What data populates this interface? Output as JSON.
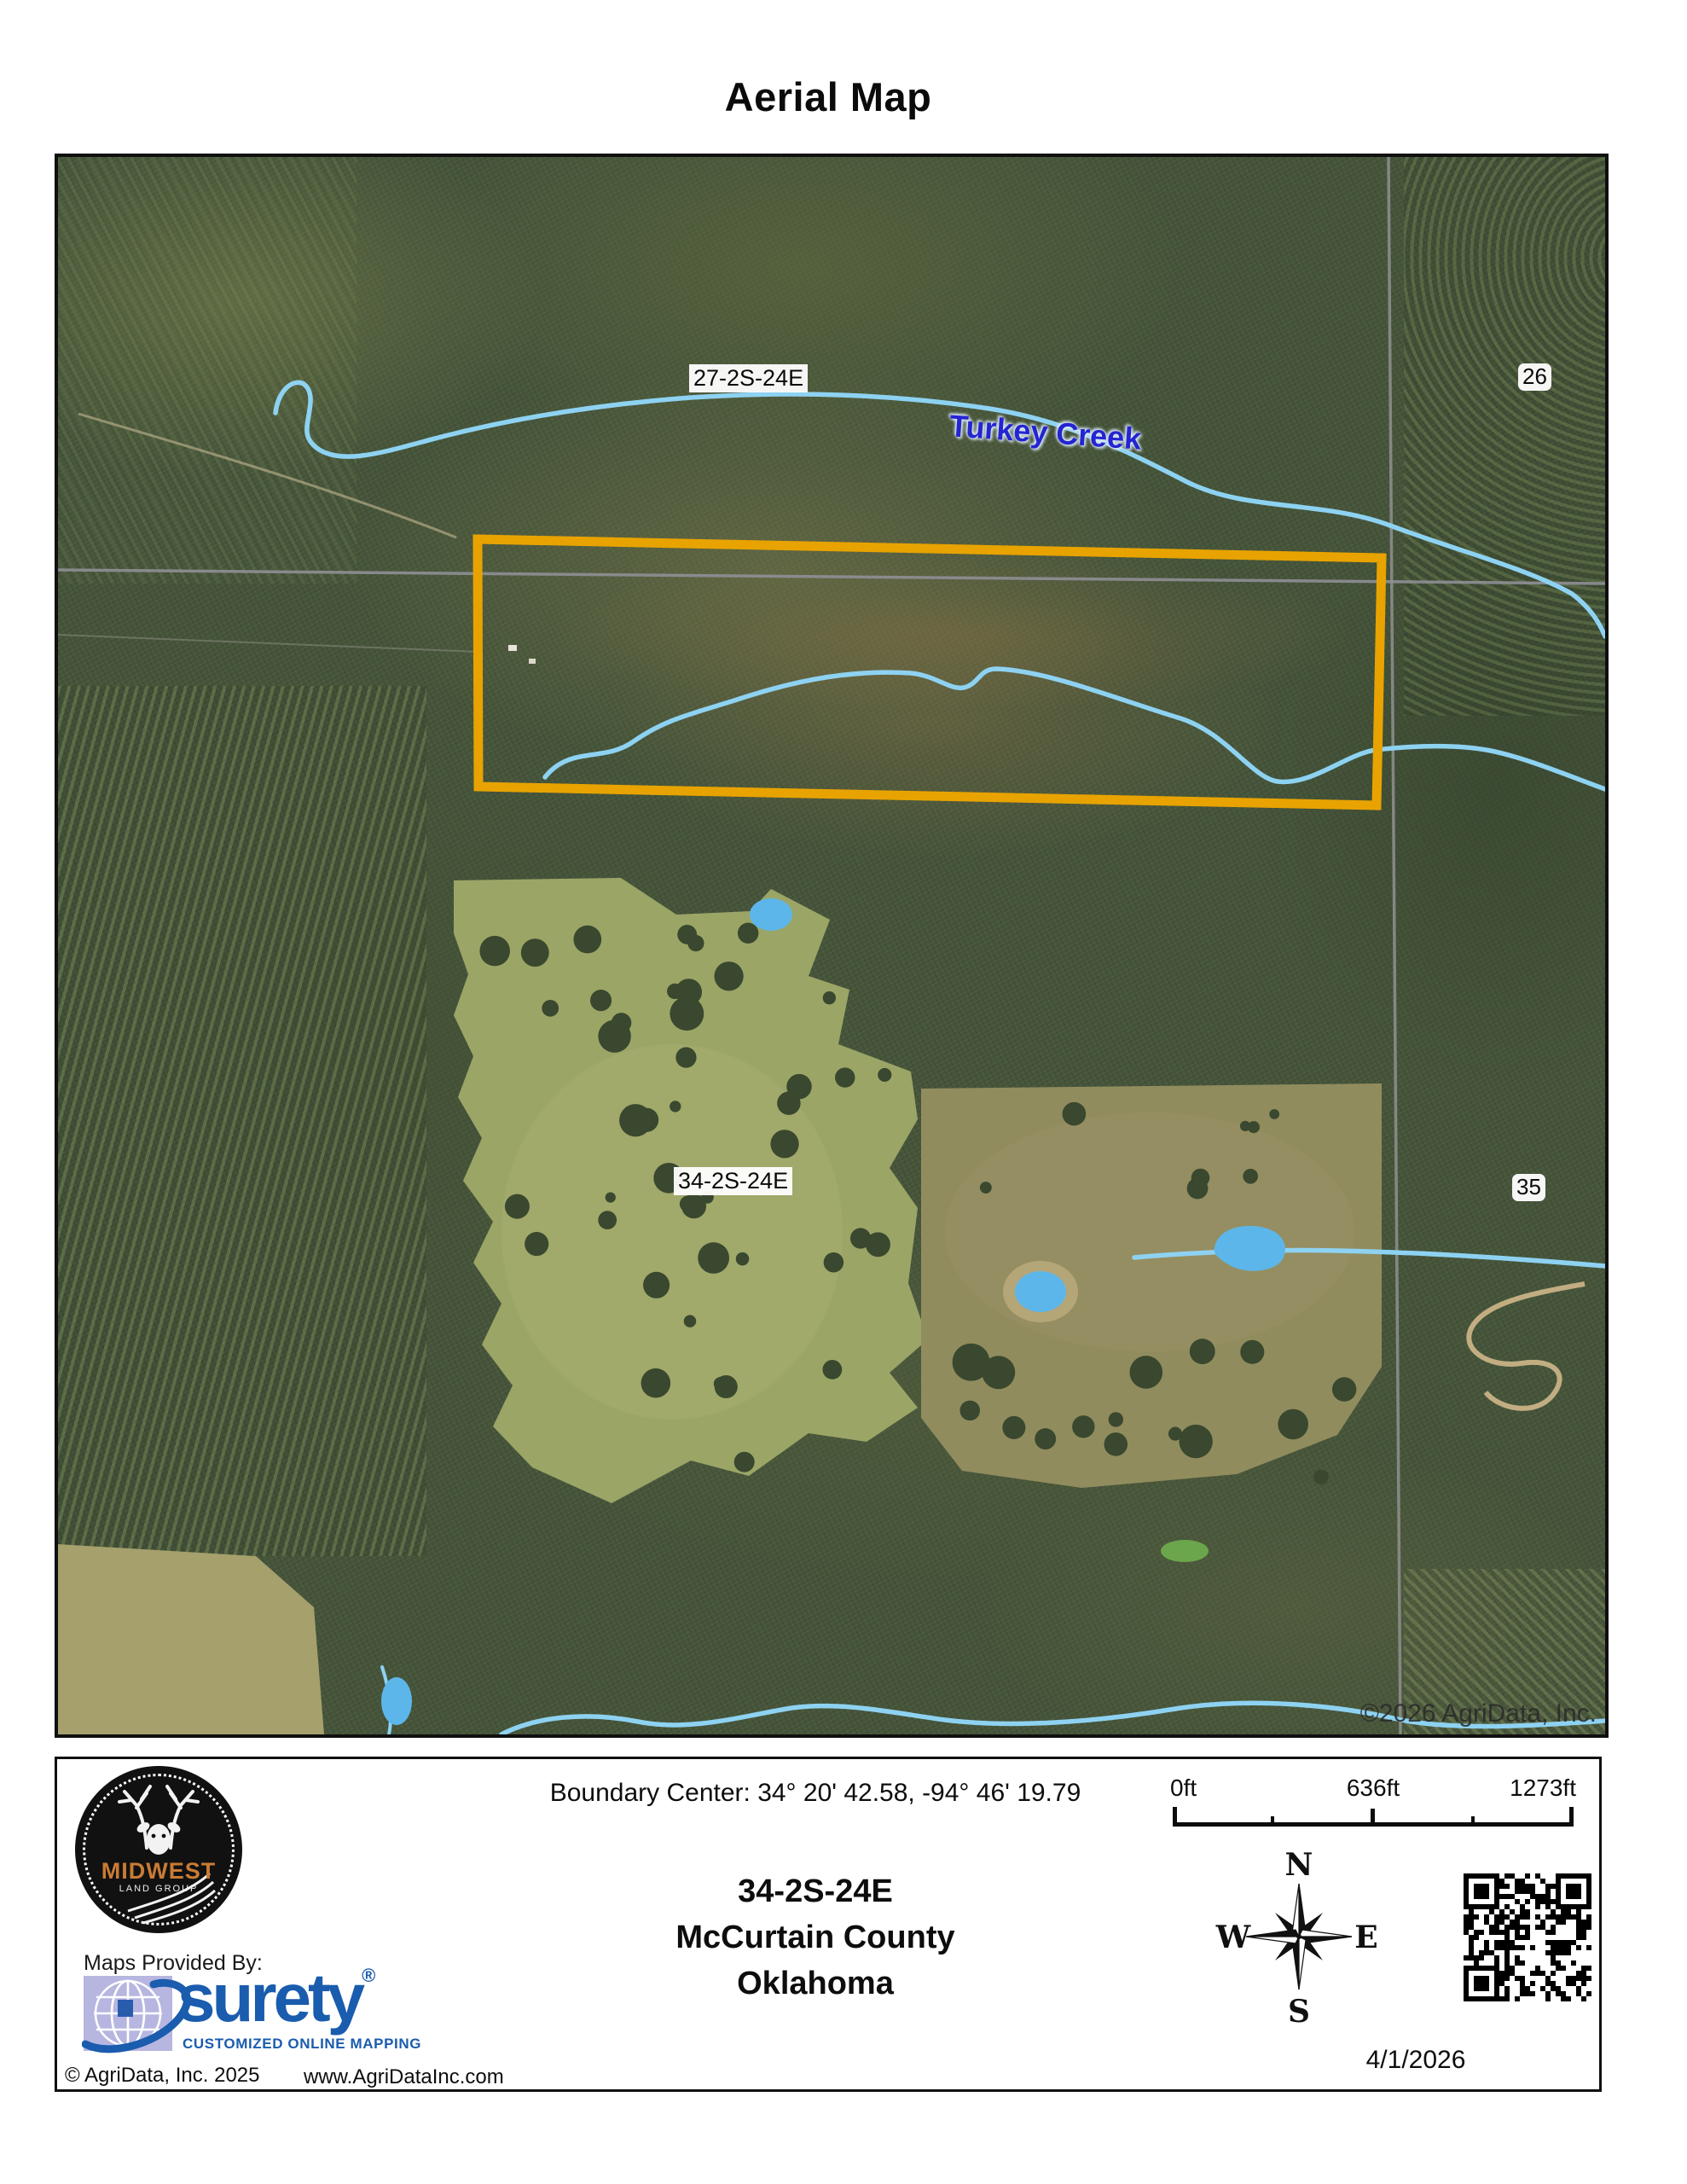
{
  "page": {
    "title": "Aerial Map"
  },
  "map": {
    "labels": {
      "section_27": "27-2S-24E",
      "section_26": "26",
      "section_34": "34-2S-24E",
      "section_35": "35",
      "creek": "Turkey Creek",
      "watermark": "©2026 AgriData, Inc."
    },
    "colors": {
      "boundary": "#E8A301",
      "water": "#8ED2F2",
      "water_label": "#2424D2",
      "section_line": "#8F8F96"
    }
  },
  "footer": {
    "boundary_center": "Boundary Center: 34° 20' 42.58,  -94° 46' 19.79",
    "location": {
      "section": "34-2S-24E",
      "county": "McCurtain County",
      "state": "Oklahoma"
    },
    "scale": {
      "start": "0ft",
      "mid": "636ft",
      "end": "1273ft"
    },
    "compass": {
      "n": "N",
      "s": "S",
      "e": "E",
      "w": "W"
    },
    "provider": {
      "maps_provided_by": "Maps Provided By:",
      "brand": "surety",
      "reg": "®",
      "tagline": "CUSTOMIZED ONLINE MAPPING",
      "copyright": "© AgriData, Inc. 2025",
      "website": "www.AgriDataInc.com"
    },
    "logo": {
      "brand": "MIDWEST",
      "sub": "LAND GROUP"
    },
    "date": "4/1/2026"
  }
}
